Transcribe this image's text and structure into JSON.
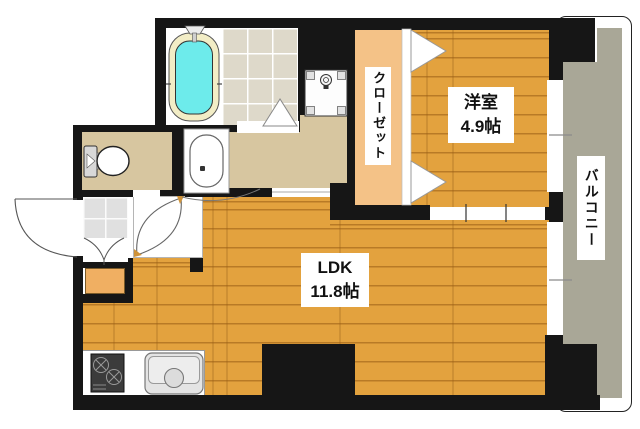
{
  "plan": {
    "rooms": {
      "western_room": {
        "name": "洋室",
        "size": "4.9帖"
      },
      "ldk": {
        "name": "LDK",
        "size": "11.8帖"
      },
      "closet": {
        "name": "クローゼット"
      },
      "balcony": {
        "name": "バルコニー"
      }
    },
    "fixtures": [
      "bathtub",
      "shower-door",
      "washing-machine-pan",
      "washbasin",
      "toilet",
      "entrance-door",
      "genkan-step",
      "shoe-cabinet",
      "gas-stove",
      "kitchen-sink",
      "folding-closet-door",
      "sliding-door",
      "window"
    ]
  },
  "colors": {
    "wall": "#161616",
    "wood": "#e3a23e",
    "closet-floor": "#f4c287",
    "tan": "#d7c6a0",
    "bath-tile": "#ded9ca",
    "genkan-tile": "#e0e0e0",
    "balcony": "#a9a797",
    "tub": "#6debeb",
    "tub-rim": "#f2edc6",
    "hinge": "#cf9339",
    "shoe-cabinet": "#f0af62"
  }
}
